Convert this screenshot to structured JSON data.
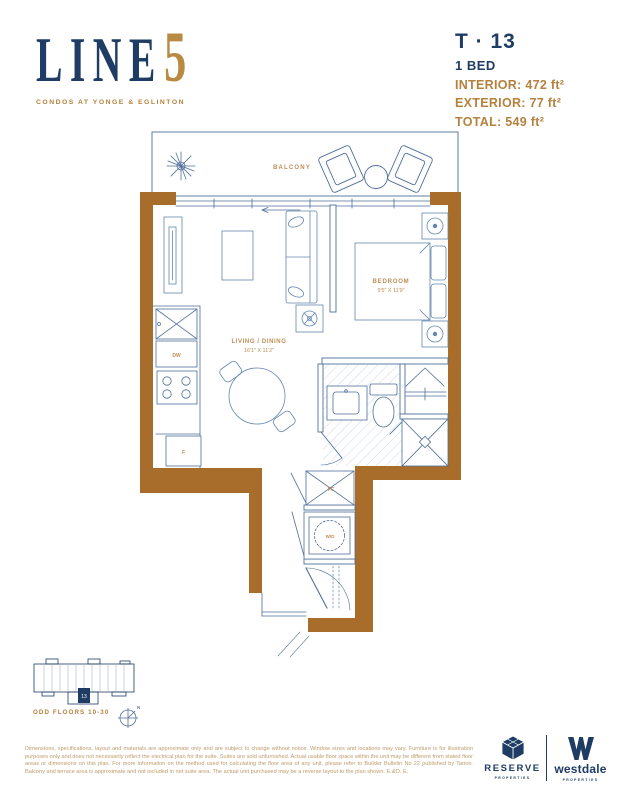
{
  "colors": {
    "navy": "#1e3c64",
    "gold": "#b5813e",
    "label_gold": "#bd8d55",
    "wall_brown": "#a86d2b",
    "plan_line": "#4f6f99"
  },
  "header": {
    "logo": {
      "line_text": "LINE",
      "five_text": "5",
      "tagline": "CONDOS AT YONGE & EGLINTON"
    },
    "unit": {
      "code": "T · 13",
      "type": "1 BED",
      "interior": "INTERIOR: 472 ft²",
      "exterior": "EXTERIOR: 77 ft²",
      "total": "TOTAL: 549 ft²"
    }
  },
  "floorplan": {
    "labels": {
      "balcony": "BALCONY",
      "bedroom": "BEDROOM",
      "bedroom_dim": "9'5\" X 11'9\"",
      "living": "LIVING / DINING",
      "living_dim": "16'1\" X 11'2\"",
      "dishwasher": "DW",
      "fridge": "F",
      "fan_coil": "FC",
      "washer_dryer": "W/D"
    }
  },
  "keyplan": {
    "unit_number": "13",
    "floors_caption": "ODD FLOORS 10-30",
    "compass_n": "N"
  },
  "disclaimer": "Dimensions, specifications, layout and materials are approximate only and are subject to change without notice. Window sizes and locations may vary. Furniture is for illustration purposes only and does not necessarily reflect the electrical plan for the suite. Suites are sold unfurnished. Actual usable floor space within the unit may be different from stated floor areas or dimensions on this plan. For more information on the method used for calculating the floor area of any unit, please refer to Builder Bulletin No 22 published by Tarion. Balcony and terrace area is approximate and not included in net suite area. The actual unit purchased may be a reverse layout to the plan shown. E.&O. E.",
  "footer": {
    "reserve": {
      "name": "RESERVE",
      "sub": "PROPERTIES"
    },
    "westdale": {
      "name": "westdale",
      "sub": "PROPERTIES"
    }
  }
}
